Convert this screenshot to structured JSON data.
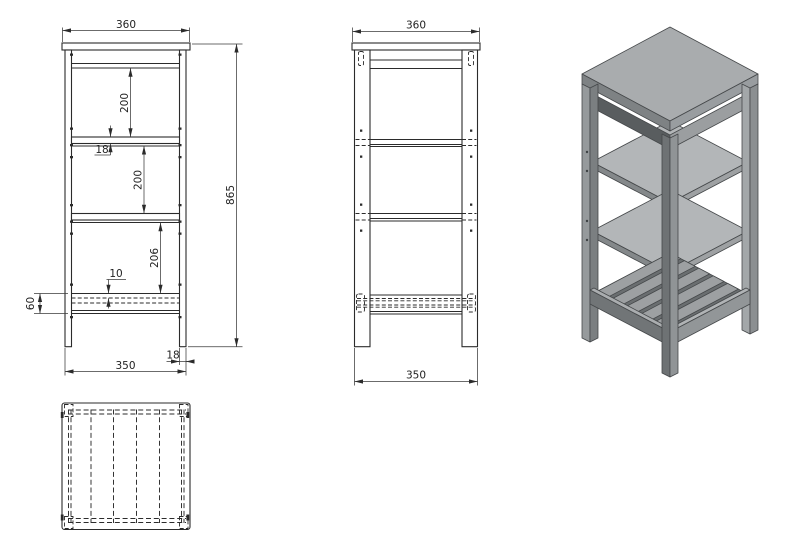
{
  "page": {
    "background_color": "#ffffff"
  },
  "drawing": {
    "kind": "furniture technical drawing - 3-shelf stand with slatted bottom shelf",
    "views": {
      "front": {
        "name": "front-elevation",
        "dimensions": {
          "top_width": "360",
          "upper_shelf_gap": "200",
          "shelf_thickness": "18",
          "middle_shelf_gap": "200",
          "lower_shelf_gap": "206",
          "slat_top_offset": "10",
          "bottom_rail_height": "60",
          "overall_height": "865",
          "leg_thickness": "18",
          "bottom_width": "350"
        }
      },
      "side": {
        "name": "side-elevation",
        "dimensions": {
          "top_width": "360",
          "bottom_width": "350"
        }
      },
      "top": {
        "name": "top-plan-view"
      },
      "isometric": {
        "name": "isometric-3d-view"
      }
    },
    "colors": {
      "line": "#2b2b2b",
      "iso_top_face": "#a9acae",
      "iso_shelf_face": "#b3b6b8",
      "iso_left_face": "#7e8284",
      "iso_right_face": "#999da0",
      "iso_apron_dark": "#595d5f",
      "background": "#ffffff"
    }
  }
}
